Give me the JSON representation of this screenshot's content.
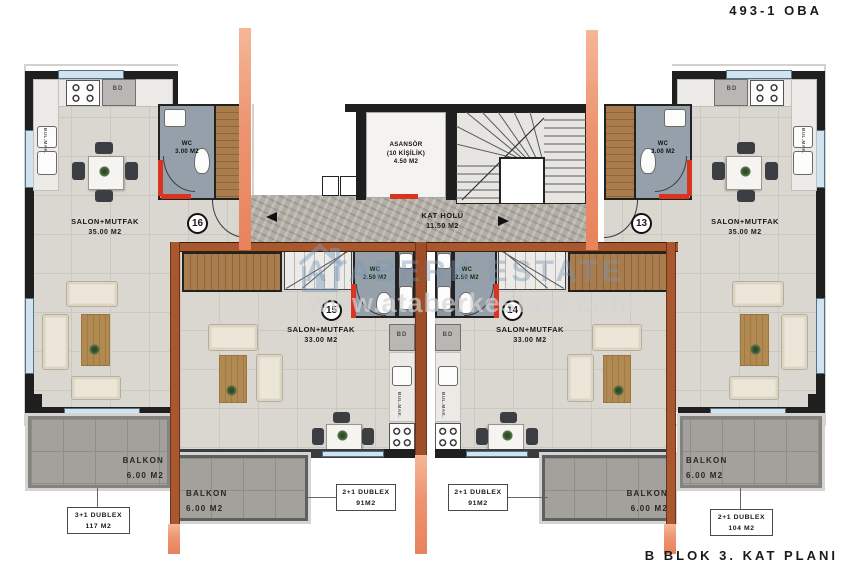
{
  "header": {
    "project_code": "493-1 OBA"
  },
  "footer": {
    "caption": "B BLOK 3. KAT PLANI"
  },
  "core": {
    "elevator": {
      "line1": "ASANSÖR",
      "line2": "(10 KİŞİLİK)",
      "line3": "4.50 M2"
    },
    "hall": {
      "line1": "KAT HOLÜ",
      "line2": "11.50 M2"
    }
  },
  "units": [
    {
      "number": "16",
      "room": "SALON+MUTFAK",
      "area": "35.00 M2",
      "wc_label": "WC",
      "wc_area": "3.00 M2",
      "balcony_label": "BALKON",
      "balcony_area": "6.00 M2",
      "tag_line1": "3+1 DUBLEX",
      "tag_line2": "117 M2"
    },
    {
      "number": "15",
      "room": "SALON+MUTFAK",
      "area": "33.00 M2",
      "wc_label": "WC",
      "wc_area": "2.50 M2",
      "balcony_label": "BALKON",
      "balcony_area": "6.00 M2",
      "tag_line1": "2+1 DUBLEX",
      "tag_line2": "91M2"
    },
    {
      "number": "14",
      "room": "SALON+MUTFAK",
      "area": "33.00 M2",
      "wc_label": "WC",
      "wc_area": "2.50 M2",
      "balcony_label": "BALKON",
      "balcony_area": "6.00 M2",
      "tag_line1": "2+1 DUBLEX",
      "tag_line2": "91M2"
    },
    {
      "number": "13",
      "room": "SALON+MUTFAK",
      "area": "35.00 M2",
      "wc_label": "WC",
      "wc_area": "3.00 M2",
      "balcony_label": "BALKON",
      "balcony_area": "6.00 M2",
      "tag_line1": "2+1 DUBLEX",
      "tag_line2": "104 M2"
    }
  ],
  "appliances": {
    "fridge": "BD",
    "machine": "BUL.MAK."
  },
  "watermark": {
    "brand": "ATABERK ESTATE",
    "url": "www.ataberkestate.com"
  },
  "colors": {
    "section_line": "#EC9470",
    "wall": "#1F1F1F",
    "cut_wall": "#A9572E",
    "accent_red": "#D93322",
    "wc_floor": "#95A0AA",
    "balcony_floor": "#A4A19C",
    "window": "#CFE3F0",
    "wood": "#A87C4C",
    "watermark_blue": "#8FA8BF"
  }
}
